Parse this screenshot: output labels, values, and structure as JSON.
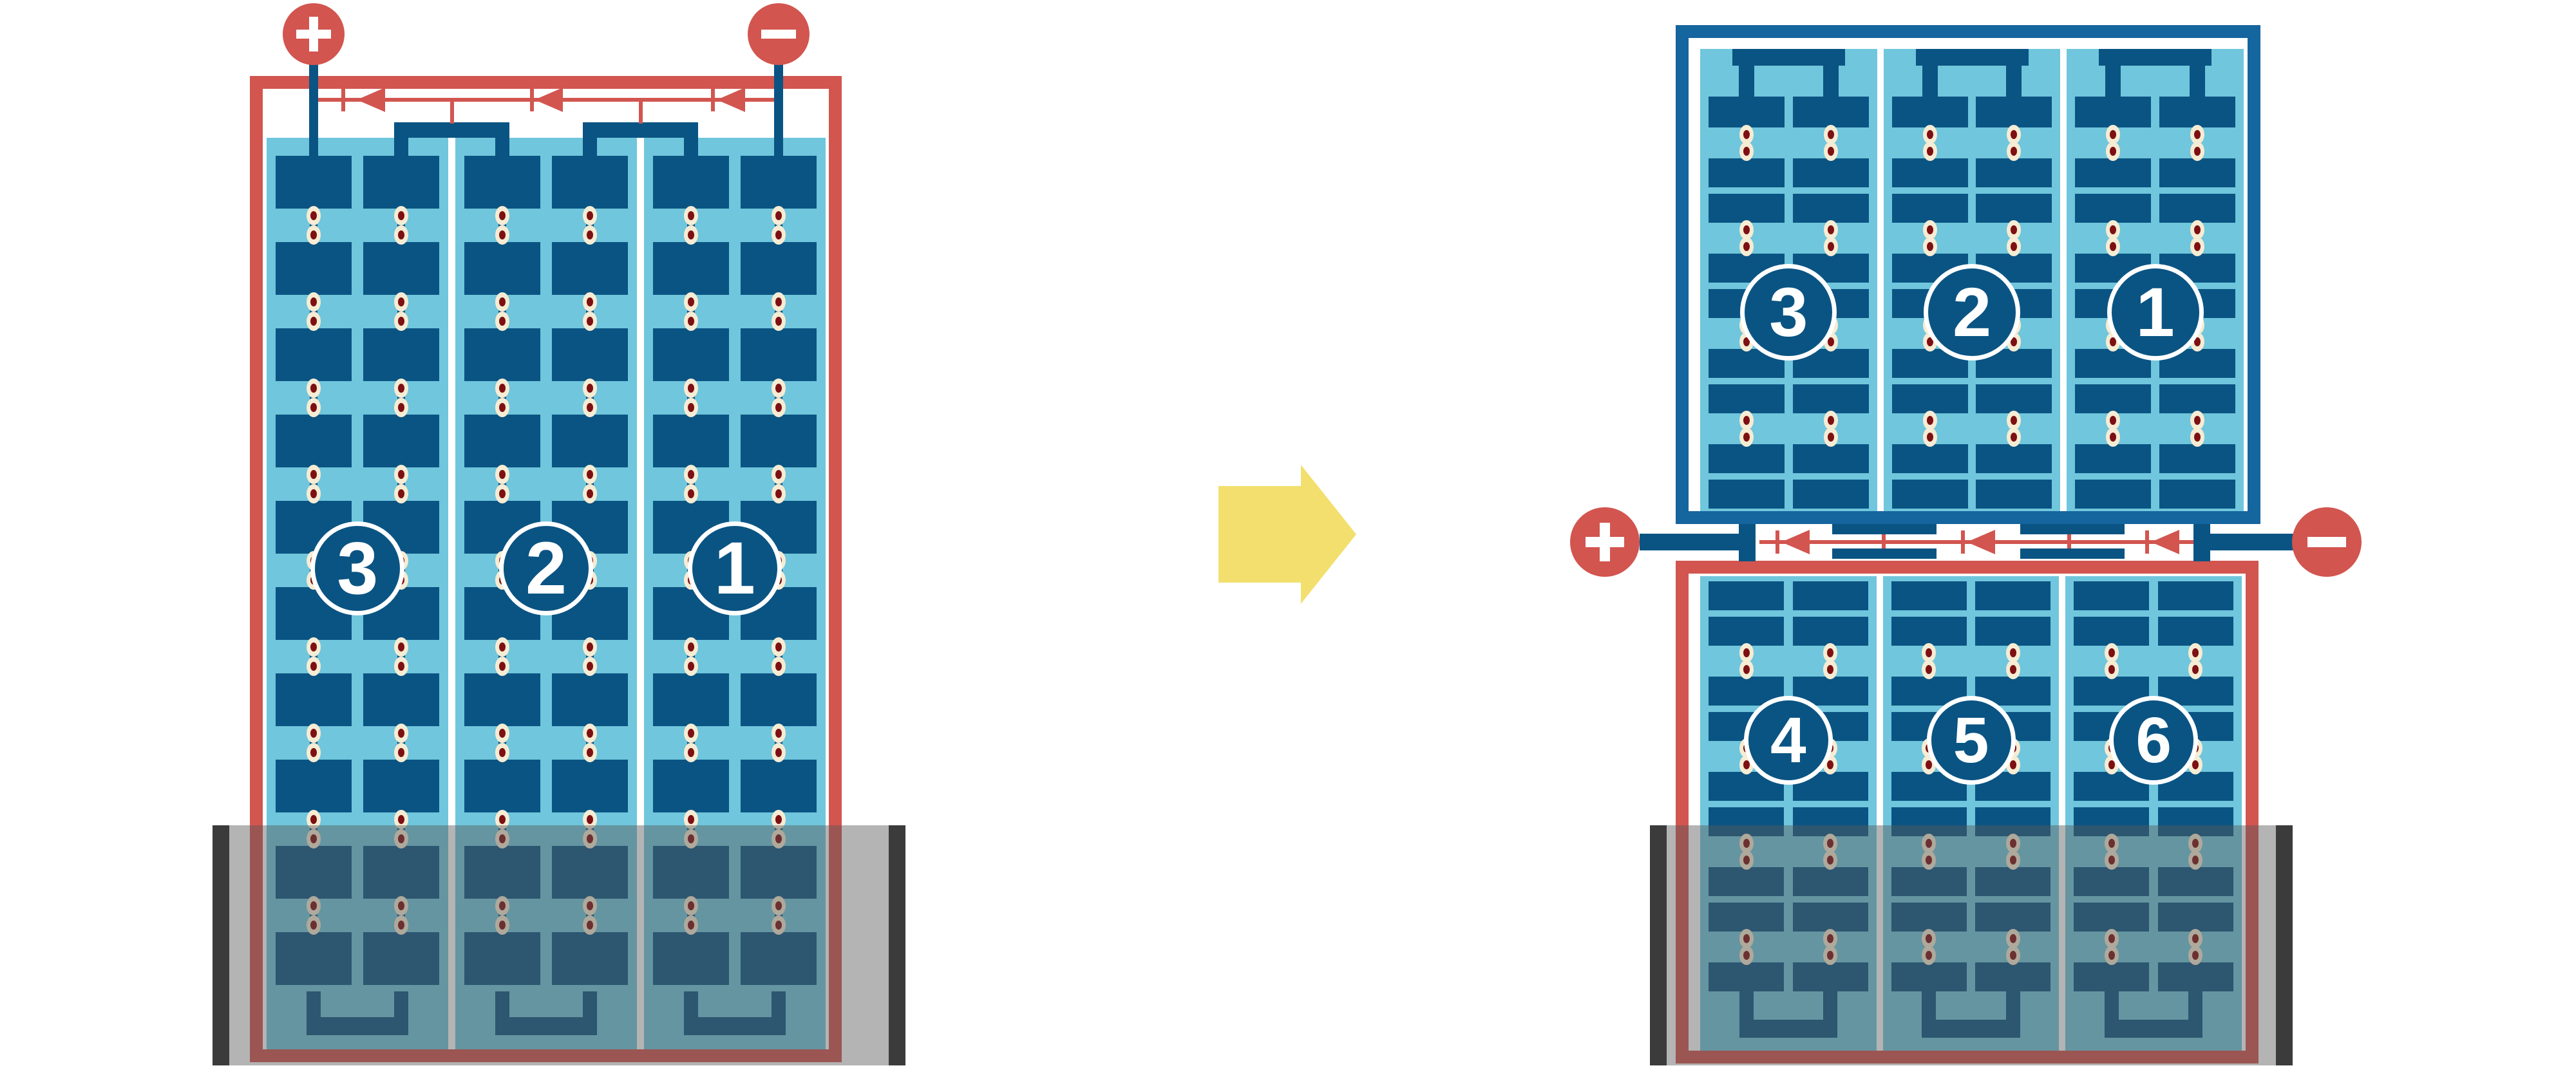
{
  "figure": {
    "description": "Battery cell arrangement diagram: single 3-cell battery rearranged into a stacked 6-cell battery",
    "background": "#ffffff"
  },
  "colors": {
    "red": "#d2554f",
    "navy": "#0a5483",
    "frame_blue": "#15659f",
    "light_blue": "#70c6dc",
    "cream": "#f6ecd4",
    "maroon": "#7d1012",
    "yellow": "#f2df6e",
    "cap_gray": "#3b3b3c",
    "band_tint": "rgba(88,88,88,0.45)",
    "white": "#ffffff"
  },
  "before": {
    "terminals": {
      "positive": {
        "symbol": "+"
      },
      "negative": {
        "symbol": "−"
      }
    },
    "cells": [
      {
        "label": "3"
      },
      {
        "label": "2"
      },
      {
        "label": "1"
      }
    ]
  },
  "after": {
    "terminals": {
      "positive": {
        "symbol": "+"
      },
      "negative": {
        "symbol": "−"
      }
    },
    "top_unit": {
      "cells": [
        {
          "label": "3"
        },
        {
          "label": "2"
        },
        {
          "label": "1"
        }
      ]
    },
    "bottom_unit": {
      "cells": [
        {
          "label": "4"
        },
        {
          "label": "5"
        },
        {
          "label": "6"
        }
      ]
    }
  },
  "transform_arrow": {
    "direction": "right"
  }
}
